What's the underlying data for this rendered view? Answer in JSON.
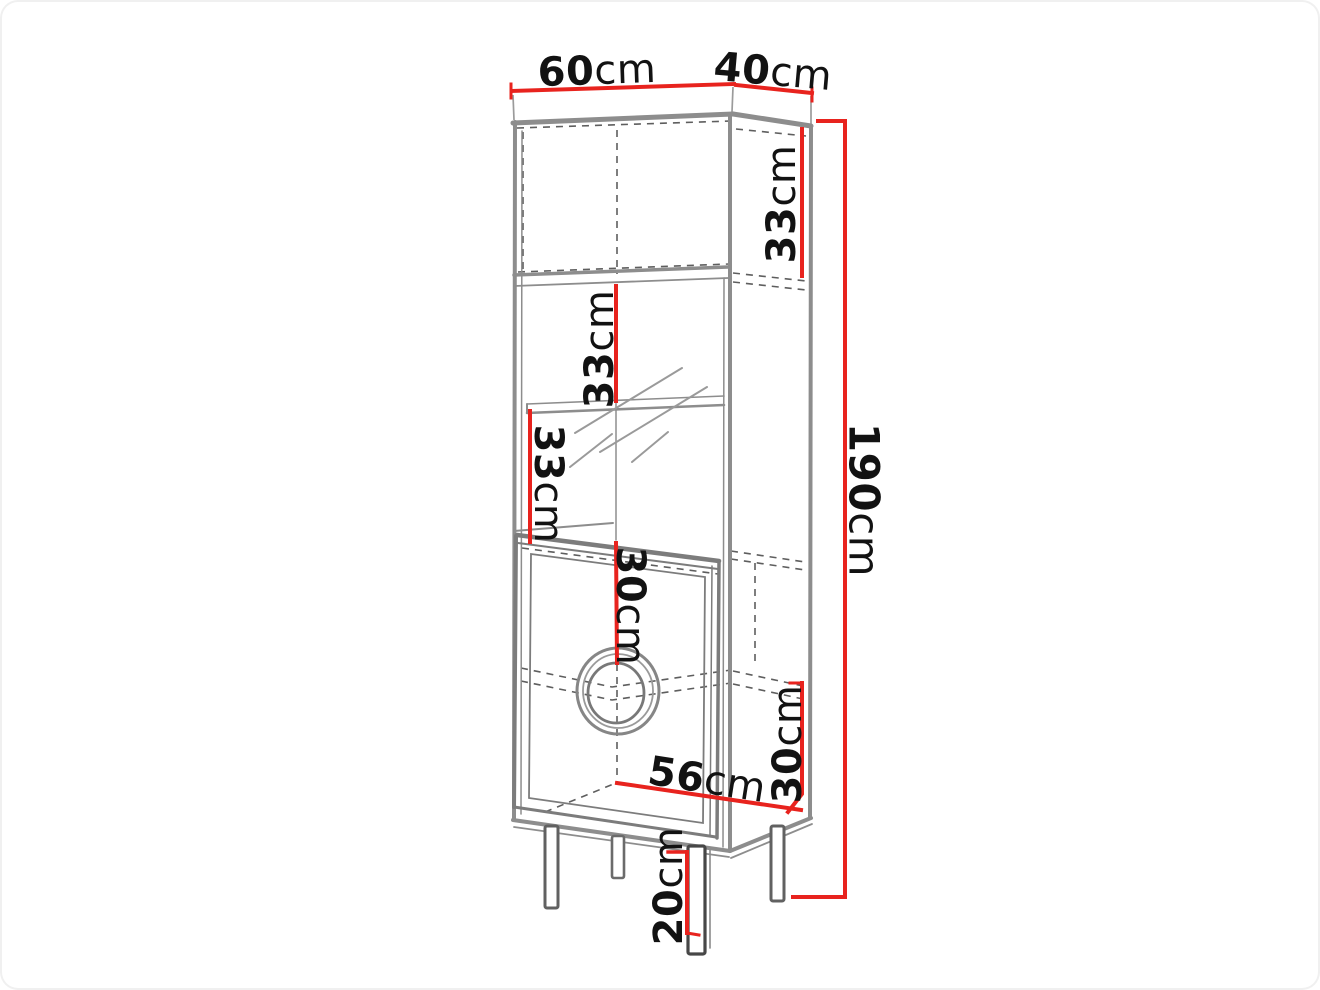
{
  "colors": {
    "red": "#e8231e",
    "gray": "#8d8d8d",
    "gray_dark": "#5e5e5e",
    "line_thin": "#9b9b9b",
    "text": "#121212",
    "bg": "#ffffff"
  },
  "labels": {
    "width_top": {
      "value": "60",
      "unit": "cm"
    },
    "depth_top": {
      "value": "40",
      "unit": "cm"
    },
    "total_height": {
      "value": "190",
      "unit": "cm"
    },
    "top_compartment": {
      "value": "33",
      "unit": "cm"
    },
    "upper_open_shelf": {
      "value": "33",
      "unit": "cm"
    },
    "lower_open_shelf": {
      "value": "33",
      "unit": "cm"
    },
    "door_upper": {
      "value": "30",
      "unit": "cm"
    },
    "door_lower": {
      "value": "30",
      "unit": "cm"
    },
    "interior_width": {
      "value": "56",
      "unit": "cm"
    },
    "leg_height": {
      "value": "20",
      "unit": "cm"
    }
  }
}
